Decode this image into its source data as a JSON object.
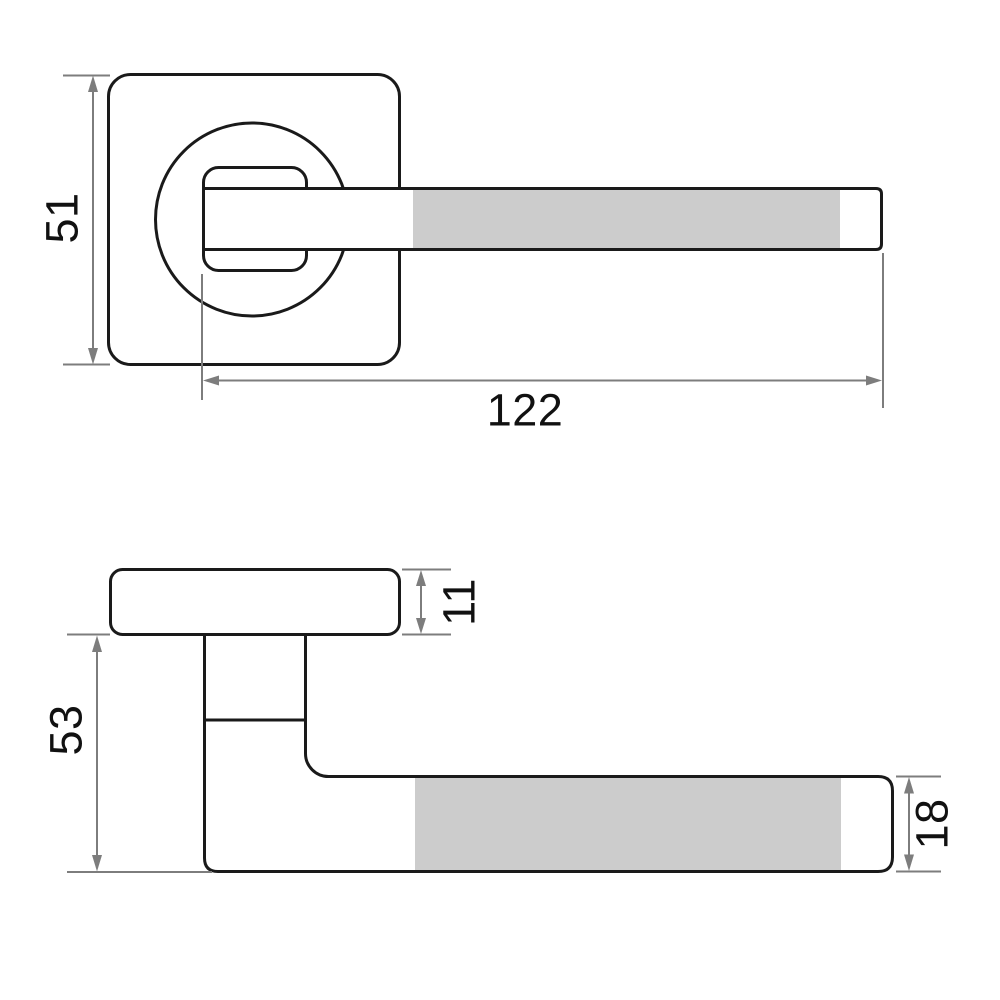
{
  "diagram": {
    "type": "technical-drawing",
    "subject": "lever door handle on square rosette, front and side orthographic views with dimensions",
    "top_view": {
      "rosette_size_label": "51",
      "handle_length_label": "122"
    },
    "side_view": {
      "rosette_thickness_label": "11",
      "handle_projection_label": "53",
      "lever_thickness_label": "18"
    },
    "colors": {
      "outline": "#1a1a1a",
      "dimension_gray": "#7d7d7d",
      "highlight_fill": "#cccccc",
      "background": "#ffffff"
    }
  }
}
